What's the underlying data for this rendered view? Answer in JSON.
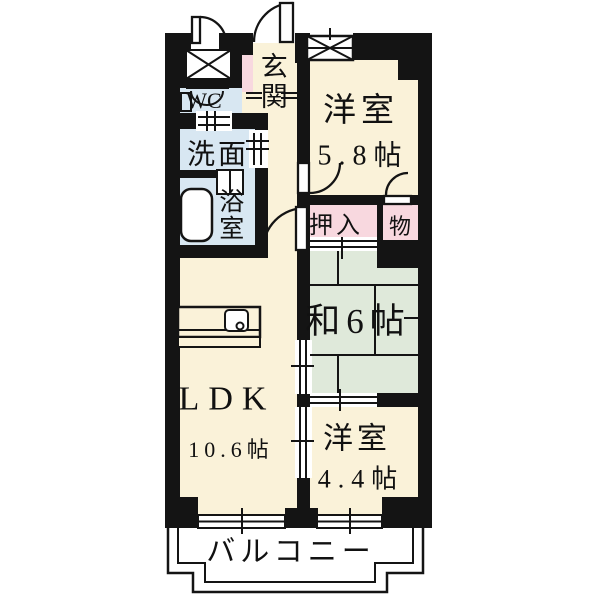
{
  "floorplan": {
    "type": "apartment-madori",
    "rooms": {
      "genkan": {
        "label": "玄関"
      },
      "wc": {
        "label": "WC"
      },
      "washroom": {
        "label": "洗面"
      },
      "bathroom": {
        "label": "浴室"
      },
      "western_room_1": {
        "label": "洋室",
        "size": "5.8帖"
      },
      "closet": {
        "label": "押入"
      },
      "storage": {
        "label": "物"
      },
      "japanese_room": {
        "label": "和6帖"
      },
      "ldk": {
        "label": "LDK",
        "size": "10.6帖"
      },
      "western_room_2": {
        "label": "洋室",
        "size": "4.4帖"
      },
      "balcony": {
        "label": "バルコニー"
      }
    },
    "colors": {
      "wall": "#141414",
      "flooring_cream": "#faf2d9",
      "closet_pink": "#f8d8df",
      "wet_area_blue": "#d8e7f2",
      "tatami_green": "#dfe9da",
      "background": "#ffffff"
    }
  }
}
